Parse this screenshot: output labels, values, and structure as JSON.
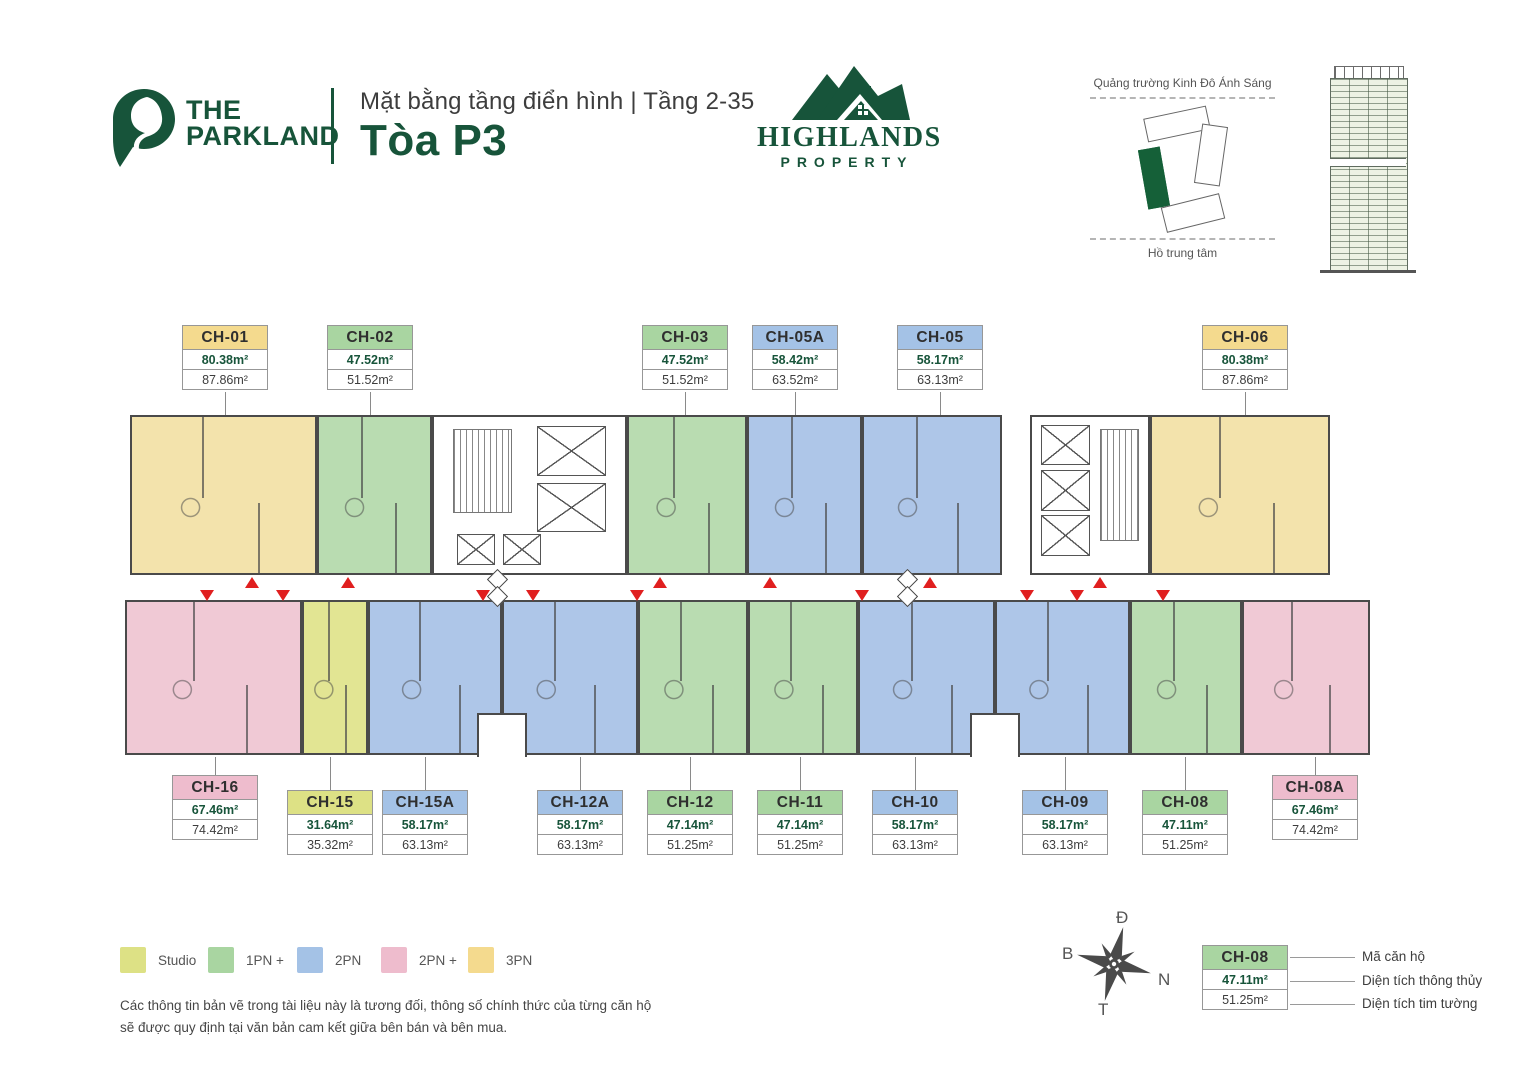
{
  "header": {
    "logo": {
      "line1": "THE",
      "line2": "PARKLAND"
    },
    "subtitle": "Mặt bằng tầng điển hình | Tầng 2-35",
    "title": "Tòa P3",
    "developer": {
      "line1": "HIGHLANDS",
      "line2": "PROPERTY"
    }
  },
  "site_map": {
    "top_label": "Quảng trường Kinh Đô Ánh Sáng",
    "bottom_label": "Hồ trung tâm"
  },
  "units": [
    {
      "id": "CH-01",
      "type": "3PN",
      "net": "80.38m²",
      "gross": "87.86m²"
    },
    {
      "id": "CH-02",
      "type": "1PN +",
      "net": "47.52m²",
      "gross": "51.52m²"
    },
    {
      "id": "CH-03",
      "type": "1PN +",
      "net": "47.52m²",
      "gross": "51.52m²"
    },
    {
      "id": "CH-05A",
      "type": "2PN",
      "net": "58.42m²",
      "gross": "63.52m²"
    },
    {
      "id": "CH-05",
      "type": "2PN",
      "net": "58.17m²",
      "gross": "63.13m²"
    },
    {
      "id": "CH-06",
      "type": "3PN",
      "net": "80.38m²",
      "gross": "87.86m²"
    },
    {
      "id": "CH-16",
      "type": "2PN +",
      "net": "67.46m²",
      "gross": "74.42m²"
    },
    {
      "id": "CH-15",
      "type": "Studio",
      "net": "31.64m²",
      "gross": "35.32m²"
    },
    {
      "id": "CH-15A",
      "type": "2PN",
      "net": "58.17m²",
      "gross": "63.13m²"
    },
    {
      "id": "CH-12A",
      "type": "2PN",
      "net": "58.17m²",
      "gross": "63.13m²"
    },
    {
      "id": "CH-12",
      "type": "1PN +",
      "net": "47.14m²",
      "gross": "51.25m²"
    },
    {
      "id": "CH-11",
      "type": "1PN +",
      "net": "47.14m²",
      "gross": "51.25m²"
    },
    {
      "id": "CH-10",
      "type": "2PN",
      "net": "58.17m²",
      "gross": "63.13m²"
    },
    {
      "id": "CH-09",
      "type": "2PN",
      "net": "58.17m²",
      "gross": "63.13m²"
    },
    {
      "id": "CH-08",
      "type": "1PN +",
      "net": "47.11m²",
      "gross": "51.25m²"
    },
    {
      "id": "CH-08A",
      "type": "2PN +",
      "net": "67.46m²",
      "gross": "74.42m²"
    }
  ],
  "legend": [
    {
      "label": "Studio",
      "color": "#dde185"
    },
    {
      "label": "1PN +",
      "color": "#a9d5a1"
    },
    {
      "label": "2PN",
      "color": "#a4c2e6"
    },
    {
      "label": "2PN +",
      "color": "#eebccd"
    },
    {
      "label": "3PN",
      "color": "#f4da8e"
    }
  ],
  "disclaimer": [
    "Các thông tin bản vẽ trong tài liệu này là tương đối, thông số chính thức của từng căn hộ",
    "sẽ được quy định tại văn bản cam kết giữa bên bán và bên mua."
  ],
  "compass": {
    "top": "Đ",
    "left": "B",
    "right": "N",
    "bottom": "T"
  },
  "key_box": {
    "code": "CH-08",
    "net": "47.11m²",
    "gross": "51.25m²",
    "labels": [
      "Mã căn hộ",
      "Diện tích thông thủy",
      "Diện tích tim tường"
    ]
  },
  "colors": {
    "brand_green": "#17543a",
    "accent_red": "#e01f1f",
    "wall": "#4a4a4a",
    "unit_fill": {
      "Studio": "#e2e593",
      "1PN +": "#b9dcb1",
      "2PN": "#aec6e8",
      "2PN +": "#f0c9d5",
      "3PN": "#f3e3ac"
    },
    "label_fill": {
      "Studio": "#dde185",
      "1PN +": "#a9d5a1",
      "2PN": "#a4c2e6",
      "2PN +": "#eebccd",
      "3PN": "#f4da8e"
    }
  }
}
